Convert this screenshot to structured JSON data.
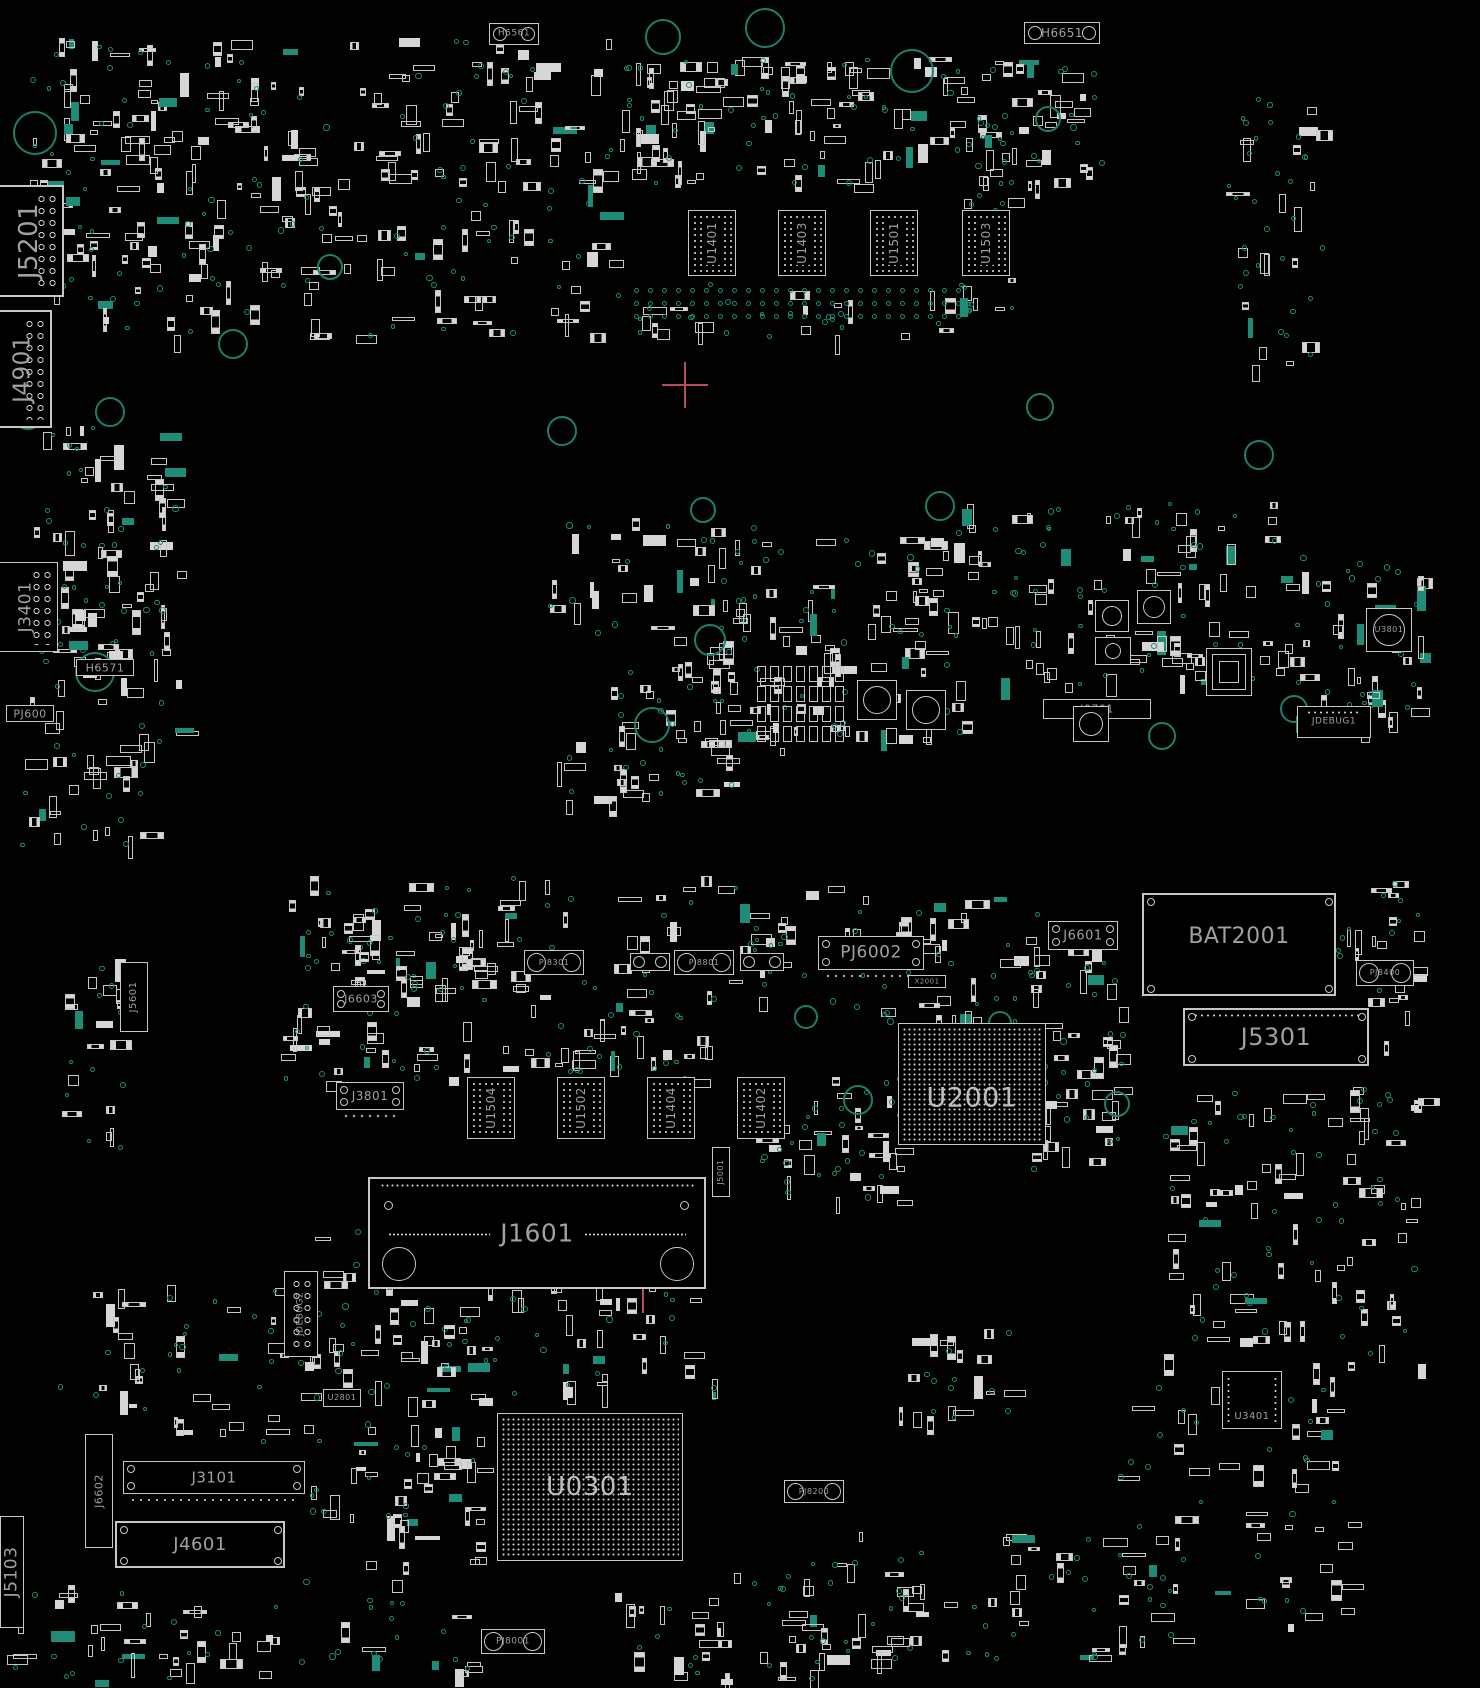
{
  "canvas": {
    "w": 1480,
    "h": 1688,
    "bg": "#020202"
  },
  "colors": {
    "outline": "#c6c6c6",
    "fill": "#d6d6d6",
    "text": "#a0a0a0",
    "via": "#1e8c76",
    "accent": "#b84d60"
  },
  "seed": 1337,
  "components": [
    {
      "id": "h6561",
      "label": "H6561",
      "x": 489,
      "y": 23,
      "w": 50,
      "h": 22,
      "type": "holes2",
      "fs": 9
    },
    {
      "id": "h6651",
      "label": "H6651",
      "x": 1024,
      "y": 22,
      "w": 76,
      "h": 22,
      "type": "holes2",
      "fs": 12
    },
    {
      "id": "j5201",
      "label": "J5201",
      "x": -6,
      "y": 185,
      "w": 70,
      "h": 112,
      "type": "box",
      "dir": "v",
      "fs": 26,
      "pincol": true,
      "bw": 2
    },
    {
      "id": "j4901",
      "label": "J4901",
      "x": -6,
      "y": 310,
      "w": 58,
      "h": 118,
      "type": "box",
      "dir": "v",
      "fs": 23,
      "pincol": true,
      "bw": 2
    },
    {
      "id": "j3401",
      "label": "J3401",
      "x": -6,
      "y": 562,
      "w": 64,
      "h": 90,
      "type": "box",
      "dir": "v",
      "fs": 17,
      "pincol": true
    },
    {
      "id": "h6571",
      "label": "H6571",
      "x": 76,
      "y": 659,
      "w": 58,
      "h": 17,
      "type": "box",
      "fs": 11
    },
    {
      "id": "pj600",
      "label": "PJ600",
      "x": 6,
      "y": 705,
      "w": 48,
      "h": 17,
      "type": "box",
      "fs": 11
    },
    {
      "id": "u3801",
      "label": "U3801",
      "x": 1366,
      "y": 608,
      "w": 46,
      "h": 44,
      "type": "switch",
      "fs": 8
    },
    {
      "id": "jdebug1",
      "label": "JDEBUG1",
      "x": 1297,
      "y": 706,
      "w": 74,
      "h": 32,
      "type": "box",
      "fs": 9,
      "dotsTop": true
    },
    {
      "id": "j0701",
      "label": "J0701",
      "x": 1043,
      "y": 699,
      "w": 108,
      "h": 20,
      "type": "box",
      "fs": 11
    },
    {
      "id": "u1401",
      "label": "U1401",
      "x": 688,
      "y": 210,
      "w": 48,
      "h": 66,
      "type": "grid",
      "dir": "v",
      "fs": 12
    },
    {
      "id": "u1403",
      "label": "U1403",
      "x": 778,
      "y": 210,
      "w": 48,
      "h": 66,
      "type": "grid",
      "dir": "v",
      "fs": 12
    },
    {
      "id": "u1501",
      "label": "U1501",
      "x": 870,
      "y": 210,
      "w": 48,
      "h": 66,
      "type": "grid",
      "dir": "v",
      "fs": 12
    },
    {
      "id": "u1503",
      "label": "U1503",
      "x": 962,
      "y": 210,
      "w": 48,
      "h": 66,
      "type": "grid",
      "dir": "v",
      "fs": 12
    },
    {
      "id": "u1504",
      "label": "U1504",
      "x": 467,
      "y": 1077,
      "w": 48,
      "h": 62,
      "type": "grid",
      "dir": "v",
      "fs": 12
    },
    {
      "id": "u1502",
      "label": "U1502",
      "x": 557,
      "y": 1077,
      "w": 48,
      "h": 62,
      "type": "grid",
      "dir": "v",
      "fs": 12
    },
    {
      "id": "u1404",
      "label": "U1404",
      "x": 647,
      "y": 1077,
      "w": 48,
      "h": 62,
      "type": "grid",
      "dir": "v",
      "fs": 12
    },
    {
      "id": "u1402",
      "label": "U1402",
      "x": 737,
      "y": 1077,
      "w": 48,
      "h": 62,
      "type": "grid",
      "dir": "v",
      "fs": 12
    },
    {
      "id": "j5601",
      "label": "J5601",
      "x": 120,
      "y": 962,
      "w": 28,
      "h": 70,
      "type": "box",
      "dir": "v",
      "fs": 10
    },
    {
      "id": "j6603",
      "label": "J6603",
      "x": 333,
      "y": 986,
      "w": 56,
      "h": 26,
      "type": "box",
      "fs": 11,
      "corners": true
    },
    {
      "id": "pj8301",
      "label": "PJ8301",
      "x": 524,
      "y": 950,
      "w": 60,
      "h": 25,
      "type": "barrel",
      "fs": 8
    },
    {
      "id": "pj8801",
      "label": "PJ8801",
      "x": 674,
      "y": 950,
      "w": 60,
      "h": 25,
      "type": "barrel",
      "fs": 8
    },
    {
      "id": "conn-a",
      "label": "",
      "x": 630,
      "y": 953,
      "w": 40,
      "h": 18,
      "type": "barrel",
      "fs": 7
    },
    {
      "id": "conn-b",
      "label": "",
      "x": 740,
      "y": 953,
      "w": 44,
      "h": 18,
      "type": "barrel",
      "fs": 7
    },
    {
      "id": "pj6002",
      "label": "PJ6002",
      "x": 818,
      "y": 936,
      "w": 106,
      "h": 34,
      "type": "box",
      "fs": 17,
      "corners": true,
      "dotsBottom": true
    },
    {
      "id": "j6601",
      "label": "J6601",
      "x": 1048,
      "y": 921,
      "w": 70,
      "h": 29,
      "type": "box",
      "fs": 13,
      "corners": true
    },
    {
      "id": "bat2001",
      "label": "BAT2001",
      "x": 1142,
      "y": 893,
      "w": 194,
      "h": 103,
      "type": "box",
      "fs": 22,
      "bw": 2,
      "corners": true,
      "labelY": 42
    },
    {
      "id": "pj8400",
      "label": "PJ8400",
      "x": 1356,
      "y": 960,
      "w": 58,
      "h": 26,
      "type": "barrel",
      "fs": 8
    },
    {
      "id": "j5301",
      "label": "J5301",
      "x": 1183,
      "y": 1008,
      "w": 186,
      "h": 58,
      "type": "box",
      "fs": 24,
      "bw": 2,
      "corners": true,
      "dotsTop": true
    },
    {
      "id": "x2001",
      "label": "X2001",
      "x": 908,
      "y": 975,
      "w": 38,
      "h": 13,
      "type": "box",
      "fs": 7
    },
    {
      "id": "u2001",
      "label": "U2001",
      "x": 898,
      "y": 1023,
      "w": 148,
      "h": 122,
      "type": "bga",
      "fs": 27,
      "labelY": 62
    },
    {
      "id": "j3801",
      "label": "J3801",
      "x": 336,
      "y": 1082,
      "w": 68,
      "h": 28,
      "type": "box",
      "fs": 12,
      "corners": true,
      "dotsBottom": true
    },
    {
      "id": "j1601",
      "label": "J1601",
      "x": 368,
      "y": 1177,
      "w": 338,
      "h": 112,
      "type": "bigconn",
      "fs": 25,
      "bw": 2
    },
    {
      "id": "j5001",
      "label": "J5001",
      "x": 712,
      "y": 1147,
      "w": 18,
      "h": 50,
      "type": "box",
      "dir": "v",
      "fs": 8
    },
    {
      "id": "jdebug2",
      "label": "JDEBUG2",
      "x": 284,
      "y": 1271,
      "w": 34,
      "h": 86,
      "type": "box",
      "dir": "v",
      "fs": 9,
      "pincol": true
    },
    {
      "id": "u2801",
      "label": "U2801",
      "x": 323,
      "y": 1389,
      "w": 38,
      "h": 18,
      "type": "box",
      "fs": 8
    },
    {
      "id": "j6602",
      "label": "J6602",
      "x": 85,
      "y": 1434,
      "w": 28,
      "h": 114,
      "type": "box",
      "dir": "v",
      "fs": 11
    },
    {
      "id": "j3101",
      "label": "J3101",
      "x": 123,
      "y": 1461,
      "w": 182,
      "h": 33,
      "type": "box",
      "fs": 15,
      "corners": true,
      "dotsBottom": true
    },
    {
      "id": "j4601",
      "label": "J4601",
      "x": 115,
      "y": 1521,
      "w": 170,
      "h": 47,
      "type": "box",
      "fs": 18,
      "bw": 2,
      "corners": true
    },
    {
      "id": "j5103",
      "label": "J5103",
      "x": 0,
      "y": 1516,
      "w": 24,
      "h": 112,
      "type": "box",
      "dir": "v",
      "fs": 17
    },
    {
      "id": "u0301",
      "label": "U0301",
      "x": 497,
      "y": 1413,
      "w": 186,
      "h": 148,
      "type": "bga",
      "fs": 26,
      "labelY": 50
    },
    {
      "id": "pj8200",
      "label": "PJ8200",
      "x": 784,
      "y": 1480,
      "w": 60,
      "h": 23,
      "type": "barrel",
      "fs": 8
    },
    {
      "id": "pj8001",
      "label": "PJ8001",
      "x": 481,
      "y": 1629,
      "w": 64,
      "h": 25,
      "type": "barrel",
      "fs": 9
    },
    {
      "id": "u3401",
      "label": "U3401",
      "x": 1222,
      "y": 1371,
      "w": 60,
      "h": 58,
      "type": "box",
      "fs": 10,
      "labelY": 80,
      "pinsLR": true
    },
    {
      "id": "sw1",
      "label": "",
      "x": 1095,
      "y": 600,
      "w": 34,
      "h": 32,
      "type": "switch"
    },
    {
      "id": "sw2",
      "label": "",
      "x": 1095,
      "y": 637,
      "w": 36,
      "h": 28,
      "type": "switch"
    },
    {
      "id": "sw3",
      "label": "",
      "x": 1137,
      "y": 590,
      "w": 34,
      "h": 34,
      "type": "switch"
    },
    {
      "id": "sw4",
      "label": "",
      "x": 1073,
      "y": 706,
      "w": 36,
      "h": 36,
      "type": "switch"
    },
    {
      "id": "sw5",
      "label": "",
      "x": 857,
      "y": 680,
      "w": 40,
      "h": 40,
      "type": "switch"
    },
    {
      "id": "sw6",
      "label": "",
      "x": 906,
      "y": 690,
      "w": 40,
      "h": 40,
      "type": "switch"
    },
    {
      "id": "qfn1",
      "label": "",
      "x": 1206,
      "y": 648,
      "w": 46,
      "h": 48,
      "type": "qfn"
    }
  ],
  "holes": [
    [
      663,
      37,
      18
    ],
    [
      765,
      28,
      20
    ],
    [
      912,
      71,
      22
    ],
    [
      35,
      133,
      22
    ],
    [
      28,
      414,
      16
    ],
    [
      110,
      412,
      15
    ],
    [
      233,
      344,
      15
    ],
    [
      330,
      267,
      13
    ],
    [
      562,
      431,
      15
    ],
    [
      703,
      510,
      13
    ],
    [
      940,
      506,
      15
    ],
    [
      1040,
      407,
      14
    ],
    [
      1259,
      455,
      15
    ],
    [
      710,
      640,
      16
    ],
    [
      652,
      725,
      18
    ],
    [
      1162,
      736,
      14
    ],
    [
      1294,
      709,
      14
    ],
    [
      806,
      1017,
      12
    ],
    [
      1000,
      1023,
      12
    ],
    [
      1117,
      1104,
      13
    ],
    [
      858,
      1100,
      15
    ],
    [
      95,
      672,
      20
    ],
    [
      1048,
      119,
      13
    ]
  ],
  "viaGrids": [
    {
      "x": 634,
      "y": 288,
      "cols": 24,
      "rows": 3,
      "dx": 14,
      "dy": 13
    }
  ],
  "padArrays": [
    {
      "x": 757,
      "y": 666,
      "cols": 7,
      "rows": 4,
      "dx": 13,
      "dy": 20,
      "w": 9,
      "h": 16
    }
  ],
  "crosshairs": [
    {
      "x": 685,
      "y": 385,
      "s": 46
    },
    {
      "x": 643,
      "y": 1282,
      "s": 62
    }
  ],
  "clusters": [
    [
      30,
      35,
      580,
      300,
      230,
      100
    ],
    [
      600,
      55,
      390,
      130,
      100,
      45
    ],
    [
      615,
      280,
      360,
      55,
      18,
      20
    ],
    [
      985,
      55,
      115,
      130,
      28,
      14
    ],
    [
      1225,
      95,
      95,
      270,
      20,
      28
    ],
    [
      28,
      420,
      150,
      330,
      65,
      35
    ],
    [
      545,
      515,
      215,
      125,
      28,
      18
    ],
    [
      610,
      635,
      360,
      115,
      70,
      25
    ],
    [
      735,
      535,
      220,
      105,
      35,
      20
    ],
    [
      955,
      500,
      350,
      185,
      85,
      45
    ],
    [
      1295,
      555,
      125,
      190,
      30,
      22
    ],
    [
      285,
      875,
      570,
      125,
      75,
      45
    ],
    [
      850,
      895,
      185,
      125,
      32,
      22
    ],
    [
      278,
      1000,
      430,
      85,
      55,
      30
    ],
    [
      755,
      1075,
      145,
      125,
      30,
      25
    ],
    [
      1028,
      945,
      95,
      225,
      38,
      22
    ],
    [
      1160,
      1085,
      260,
      280,
      75,
      45
    ],
    [
      288,
      1225,
      210,
      175,
      40,
      22
    ],
    [
      55,
      1285,
      250,
      155,
      32,
      20
    ],
    [
      298,
      1385,
      185,
      285,
      55,
      30
    ],
    [
      612,
      1555,
      300,
      125,
      45,
      25
    ],
    [
      855,
      1530,
      270,
      130,
      32,
      20
    ],
    [
      895,
      1325,
      120,
      95,
      16,
      10
    ],
    [
      1115,
      1375,
      235,
      270,
      48,
      32
    ],
    [
      425,
      1275,
      290,
      125,
      36,
      20
    ],
    [
      60,
      945,
      65,
      210,
      16,
      10
    ],
    [
      0,
      1585,
      300,
      95,
      32,
      16
    ],
    [
      340,
      930,
      180,
      60,
      25,
      12
    ],
    [
      960,
      115,
      55,
      200,
      14,
      18
    ],
    [
      1335,
      870,
      85,
      230,
      22,
      14
    ],
    [
      20,
      750,
      120,
      100,
      20,
      10
    ],
    [
      555,
      740,
      180,
      60,
      20,
      12
    ],
    [
      1180,
      640,
      60,
      40,
      8,
      6
    ],
    [
      60,
      540,
      60,
      120,
      15,
      8
    ]
  ]
}
